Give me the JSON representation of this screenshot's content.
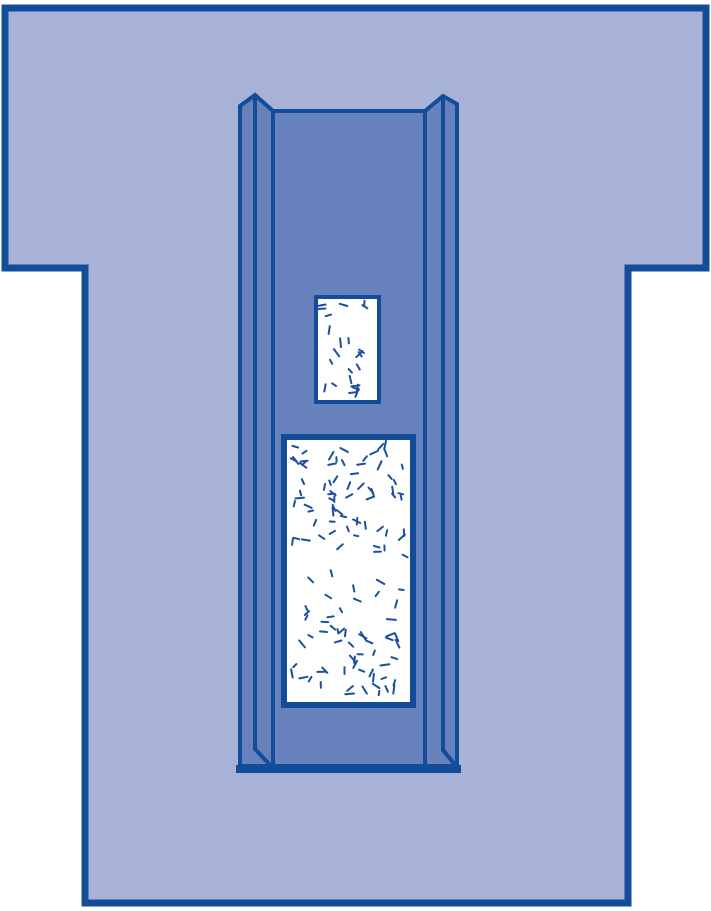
{
  "diagram": {
    "name": "surgical-drape-with-fenestration",
    "description": "T-shaped surgical drape illustration with a folded reinforcement panel in the center and two speckled fenestration / adhesive areas",
    "colors": {
      "canvas": "#ffffff",
      "drape_fill": "#a8b2d6",
      "panel_fill": "#6681bc",
      "outline": "#134c99",
      "fenestration_fill": "#ffffff",
      "speckle": "#1d4f9f"
    },
    "fenestrations": {
      "small": {
        "speckle_count": 24,
        "seed": 7,
        "dash_length": 7,
        "dash_width": 2
      },
      "large": {
        "speckle_count": 130,
        "seed": 13,
        "dash_length": 7,
        "dash_width": 2
      }
    }
  }
}
